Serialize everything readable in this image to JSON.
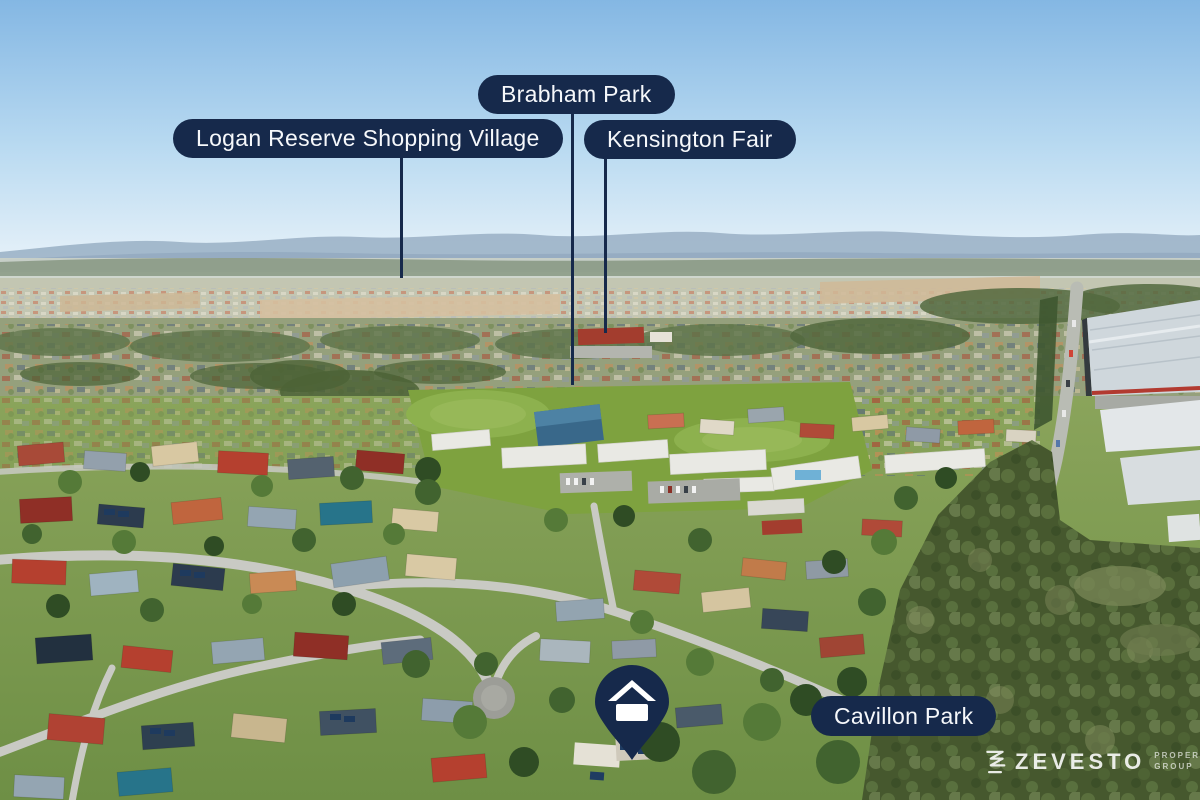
{
  "labels": {
    "brabham_park": "Brabham Park",
    "logan_reserve": "Logan Reserve Shopping Village",
    "kensington_fair": "Kensington Fair",
    "cavillon_park": "Cavillon Park"
  },
  "branding": {
    "name": "ZEVESTO",
    "tagline_line1": "PROPERTY",
    "tagline_line2": "GROUP"
  },
  "icons": {
    "property_marker": "home-pin-icon",
    "brand_mark": "zevesto-zigzag-z-icon"
  },
  "colors": {
    "label_bg": "#16294b",
    "label_text": "#f6f8fb",
    "leader_line": "#16294b",
    "pin_fill": "#16294b",
    "pin_glyph": "#ffffff",
    "logo_text": "#ffffff",
    "sky_top": "#84b7e3",
    "forest_green": "#46582e",
    "field_green": "#7ea23f"
  }
}
